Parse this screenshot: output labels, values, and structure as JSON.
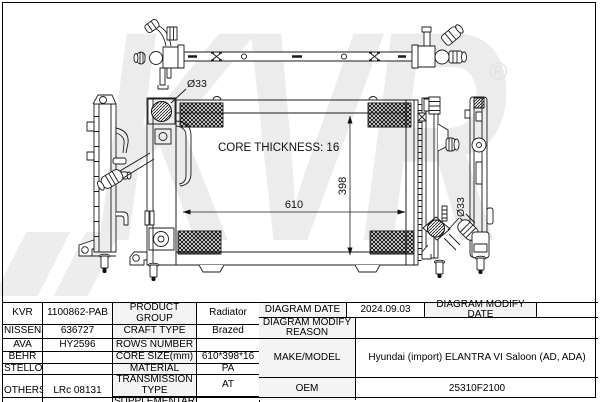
{
  "drawing": {
    "core_thickness": "CORE THICKNESS: 16",
    "core_width": "610",
    "core_height": "398",
    "inlet_diameter": "Ø33",
    "outlet_diameter": "Ø33",
    "watermark": "KVR",
    "registered": "®"
  },
  "table": {
    "brands": [
      {
        "name": "KVR",
        "code": "1100862-PAB"
      },
      {
        "name": "NISSENS",
        "code": "636727"
      },
      {
        "name": "AVA",
        "code": "HY2596"
      },
      {
        "name": "BEHR",
        "code": ""
      },
      {
        "name": "STELLOX",
        "code": ""
      },
      {
        "name": "OTHERS",
        "code": "LRc 08131"
      }
    ],
    "specs": [
      {
        "label": "PRODUCT GROUP",
        "value": "Radiator"
      },
      {
        "label": "CRAFT TYPE",
        "value": "Brazed"
      },
      {
        "label": "ROWS NUMBER",
        "value": ""
      },
      {
        "label": "CORE SIZE(mm)",
        "value": "610*398*16"
      },
      {
        "label": "MATERIAL",
        "value": "PA"
      },
      {
        "label": "TRANSMISSION TYPE",
        "value": "AT"
      },
      {
        "label": "SUPPLEMENTARY",
        "value": ""
      }
    ],
    "info": {
      "diagram_date_label": "DIAGRAM DATE",
      "diagram_date": "2024.09.03",
      "diagram_modify_date_label": "DIAGRAM MODIFY DATE",
      "diagram_modify_date": "",
      "diagram_modify_reason_label": "DIAGRAM MODIFY REASON",
      "diagram_modify_reason": "",
      "make_model_label": "MAKE/MODEL",
      "make_model": "Hyundai (import) ELANTRA VI Saloon (AD, ADA)",
      "oem_label": "OEM",
      "oem": "25310F2100"
    }
  }
}
